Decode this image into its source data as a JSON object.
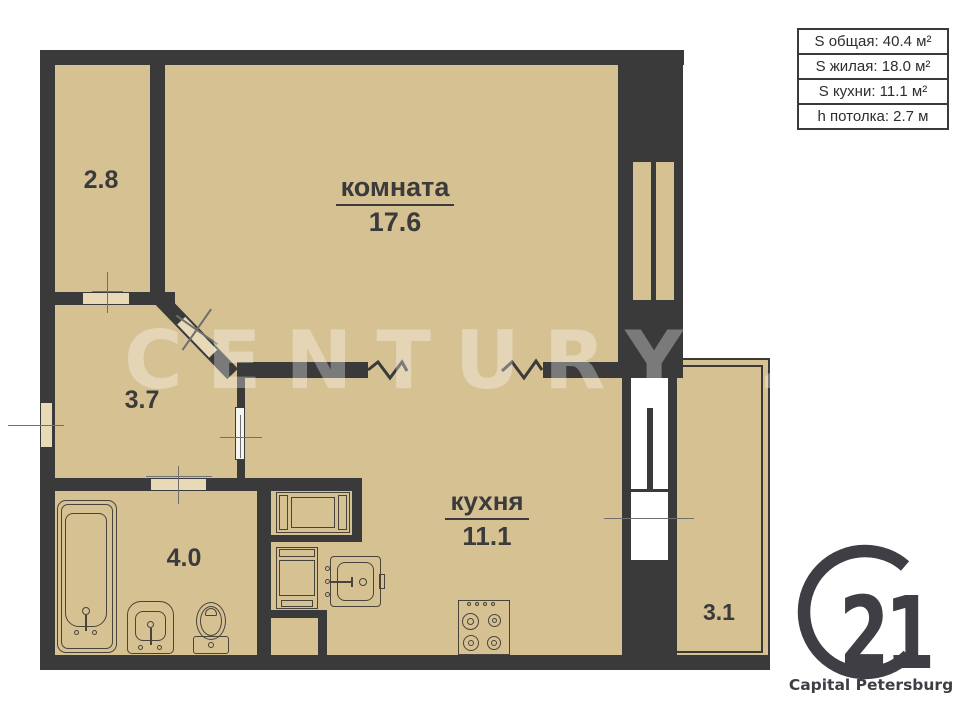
{
  "page": {
    "type": "apartment-floor-plan",
    "background": "#ffffff"
  },
  "colors": {
    "floor": "#d6c193",
    "wall": "#3a3a3a",
    "fixture_outline": "#49443b",
    "door_gap": "#e8dab6",
    "logo": "#3e3e44",
    "watermark": "rgba(255,255,255,0.33)"
  },
  "info_box": {
    "rows": [
      "S общая: 40.4 м²",
      "S жилая: 18.0 м²",
      "S кухни: 11.1 м²",
      "h потолка: 2.7 м"
    ]
  },
  "rooms": {
    "living": {
      "name": "комната",
      "area": "17.6"
    },
    "kitchen": {
      "name": "кухня",
      "area": "11.1"
    },
    "closet": {
      "area": "2.8"
    },
    "hallway": {
      "area": "3.7"
    },
    "bathroom": {
      "area": "4.0"
    },
    "balcony": {
      "area": "3.1"
    }
  },
  "watermark": {
    "text": "CENTURY 21"
  },
  "logo": {
    "number": "21",
    "subtitle": "Capital Petersburg"
  }
}
